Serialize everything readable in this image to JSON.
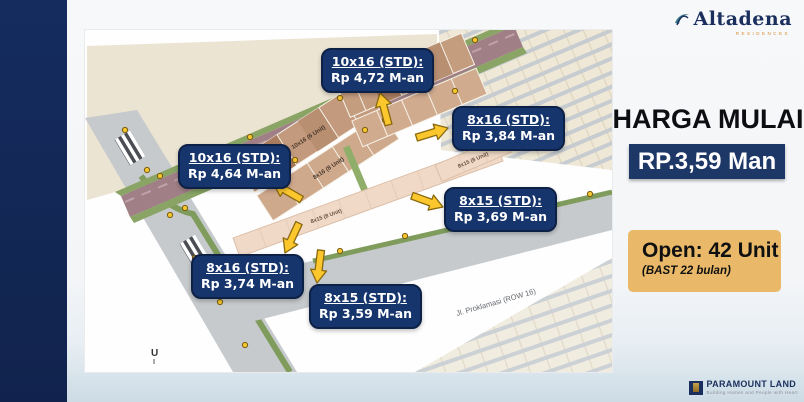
{
  "brand": {
    "logo_text": "Altadena",
    "logo_tagline": "RESIDENCES",
    "footer_logo_text": "PARAMOUNT LAND",
    "footer_tagline": "Building Homes and People with Heart"
  },
  "offer": {
    "title": "HARGA MULAI",
    "price": "RP.3,59 Man",
    "open_units": "Open: 42 Unit",
    "bast_note": "(BAST 22 bulan)"
  },
  "map": {
    "compass_label": "U",
    "road_label": "Jl. Proklamasi (ROW 16)",
    "callouts": [
      {
        "type": "10x16 (STD):",
        "price": "Rp 4,72 M-an"
      },
      {
        "type": "8x16 (STD):",
        "price": "Rp 3,84 M-an"
      },
      {
        "type": "10x16 (STD):",
        "price": "Rp 4,64 M-an"
      },
      {
        "type": "8x15 (STD):",
        "price": "Rp 3,69 M-an"
      },
      {
        "type": "8x16 (STD):",
        "price": "Rp 3,74 M-an"
      },
      {
        "type": "8x15 (STD):",
        "price": "Rp 3,59 M-an"
      }
    ],
    "block_labels": [
      "10x16 (6 Unit)",
      "8x16 (8 Unit)",
      "8x16 (8 Unit)",
      "8x15 (8 Unit)",
      "8x15 (8 Unit)"
    ]
  },
  "colors": {
    "navy_bar": "#152c5f",
    "callout_bg": "#16356d",
    "price_box_bg": "#1d3767",
    "accent_orange_box": "#e9b969",
    "arrow_yellow": "#fcc72d",
    "logo_navy": "#1b2f5e"
  }
}
